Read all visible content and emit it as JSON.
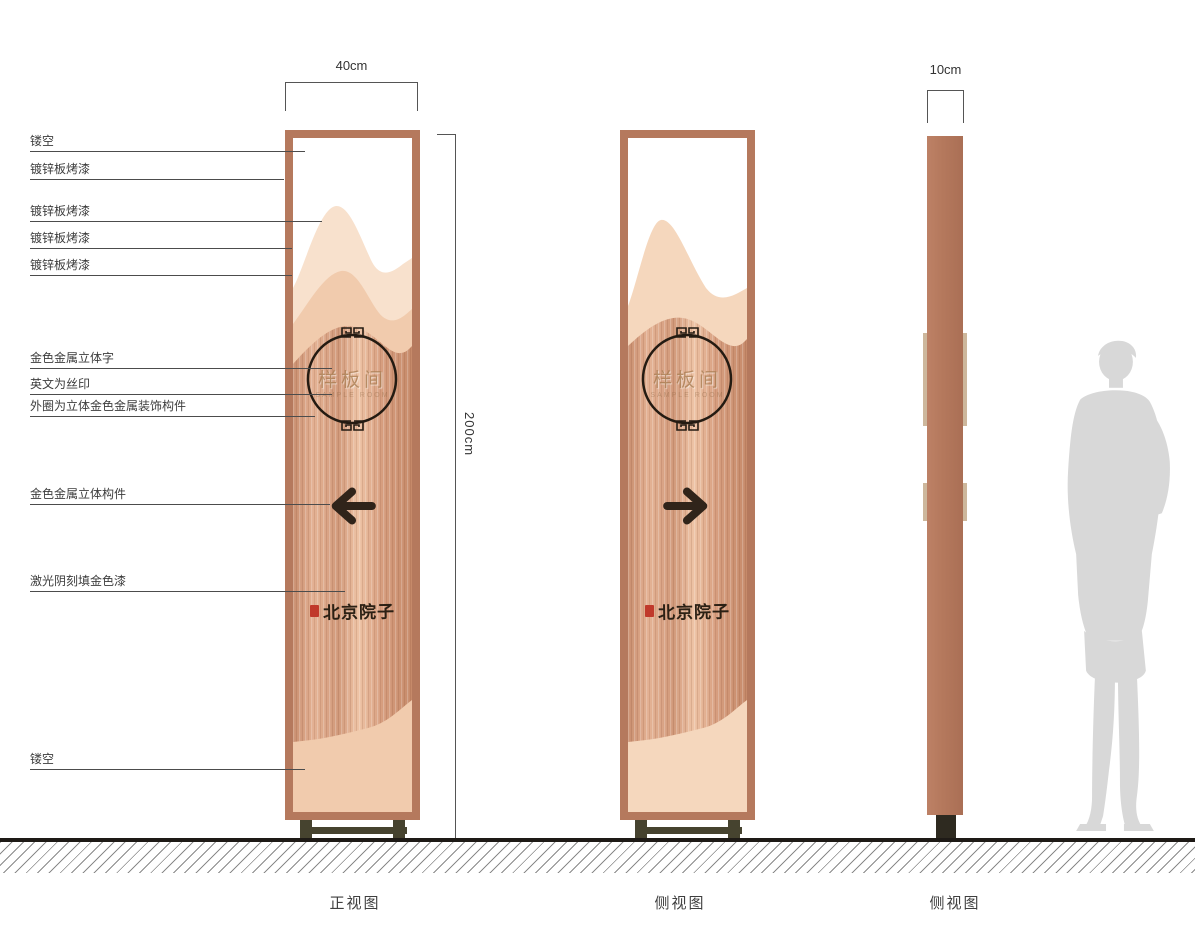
{
  "drawing": {
    "views": [
      {
        "label": "正视图"
      },
      {
        "label": "侧视图"
      },
      {
        "label": "侧视图"
      }
    ],
    "dimensions": {
      "width": "40cm",
      "height": "200cm",
      "depth": "10cm"
    },
    "callouts": [
      {
        "label": "镂空"
      },
      {
        "label": "镀锌板烤漆"
      },
      {
        "label": "镀锌板烤漆"
      },
      {
        "label": "镀锌板烤漆"
      },
      {
        "label": "镀锌板烤漆"
      },
      {
        "label": "金色金属立体字"
      },
      {
        "label": "英文为丝印"
      },
      {
        "label": "外圈为立体金色金属装饰构件"
      },
      {
        "label": "金色金属立体构件"
      },
      {
        "label": "激光阴刻填金色漆"
      },
      {
        "label": "镂空"
      }
    ],
    "sign": {
      "room_name": "样板间",
      "room_name_en": "SAMPLE ROOM",
      "brand_name": "北京院子",
      "front_arrow_direction": "left",
      "side_arrow_direction": "right"
    },
    "colors": {
      "frame": "#b5795d",
      "body": "#dca183",
      "mountain_light": "#f8e1cd",
      "mountain_mid": "#f1cbad",
      "accent_dark": "#30241a",
      "seal_red": "#c0392b",
      "silhouette": "#d8d8d8",
      "base": "#46432f"
    }
  }
}
